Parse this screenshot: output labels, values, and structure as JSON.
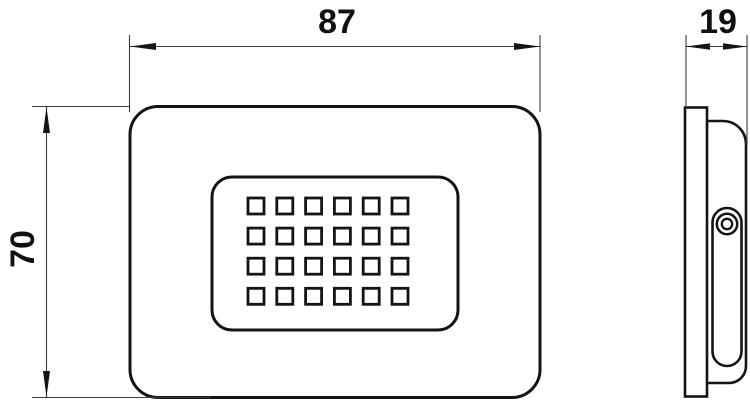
{
  "dimension_labels": {
    "width": "87",
    "depth": "19",
    "height": "70"
  },
  "front_view": {
    "led_grid": {
      "rows": 4,
      "cols": 6,
      "led_count": 24
    }
  },
  "colors": {
    "line": "#141414",
    "thin_line": "#3c3c3c",
    "background": "#ffffff"
  }
}
